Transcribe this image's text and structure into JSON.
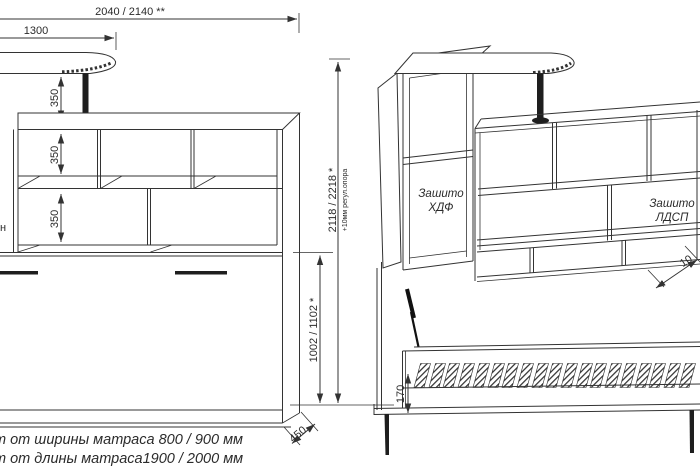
{
  "drawing": {
    "left_view": {
      "dim_total_width": "2040 / 2140 **",
      "dim_table_width": "1300",
      "dim_shelf_row_1": "350",
      "dim_shelf_row_2": "350",
      "dim_shelf_row_3": "350",
      "dim_depth": "450",
      "left_edge_text_fragment": "н"
    },
    "height_dims": {
      "dim_total_height": "2118 / 2218 *",
      "dim_total_height_note": "+10мм регул.опора",
      "dim_bed_section_height": "1002 / 1102 *"
    },
    "right_view": {
      "panel_label_hdf_line1": "Зашито",
      "panel_label_hdf_line2": "ХДФ",
      "panel_label_ldsp_line1": "Зашито",
      "panel_label_ldsp_line2": "ЛДСП",
      "dim_bed_frame_height": "170",
      "dim_partial": "10"
    },
    "footnotes": {
      "line1": "т от ширины матраса 800 / 900 мм",
      "line2": "т от длины матраса1900 / 2000 мм"
    },
    "colors": {
      "line": "#333333",
      "dark_fill": "#1e1e1e",
      "background": "#ffffff"
    }
  }
}
